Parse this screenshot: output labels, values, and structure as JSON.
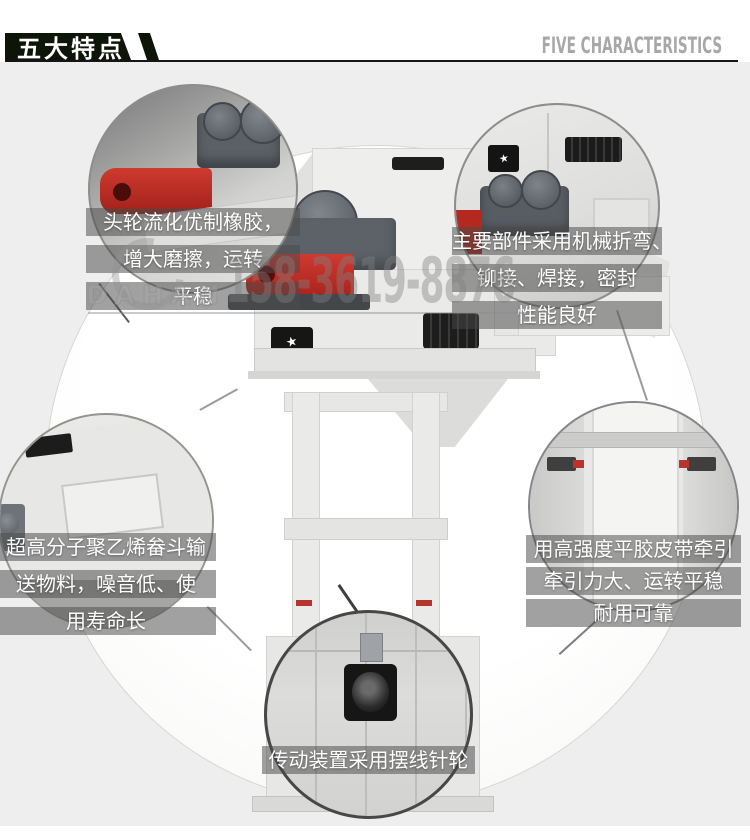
{
  "header": {
    "title_cn": "五大特点",
    "title_en": "FIVE CHARACTERISTICS"
  },
  "watermark": {
    "brand": "DAHAN",
    "phone": "158-3619-8876"
  },
  "icons": {
    "star_glyph": "★"
  },
  "callouts": [
    {
      "name": "head-wheel-rubber",
      "lines": [
        "头轮流化优制橡胶，",
        "增大磨擦，运转",
        "平稳"
      ]
    },
    {
      "name": "main-parts-fabrication",
      "lines": [
        "主要部件采用机械折弯、",
        "铆接、焊接，密封",
        "性能良好"
      ]
    },
    {
      "name": "polyethylene-bucket",
      "lines": [
        "超高分子聚乙烯畚斗输",
        "送物料，噪音低、使",
        "用寿命长"
      ]
    },
    {
      "name": "high-strength-belt",
      "lines": [
        "用高强度平胶皮带牵引",
        "牵引力大、运转平稳",
        "耐用可靠"
      ]
    },
    {
      "name": "cycloid-drive",
      "lines": [
        "传动装置采用摆线针轮"
      ]
    }
  ],
  "colors": {
    "banner": "#0d1508",
    "header_en": "#a8a8a8",
    "content_bg": "#eeeeee",
    "accent_red": "#bf3228",
    "caption_bg": "rgba(75,75,75,0.52)"
  }
}
